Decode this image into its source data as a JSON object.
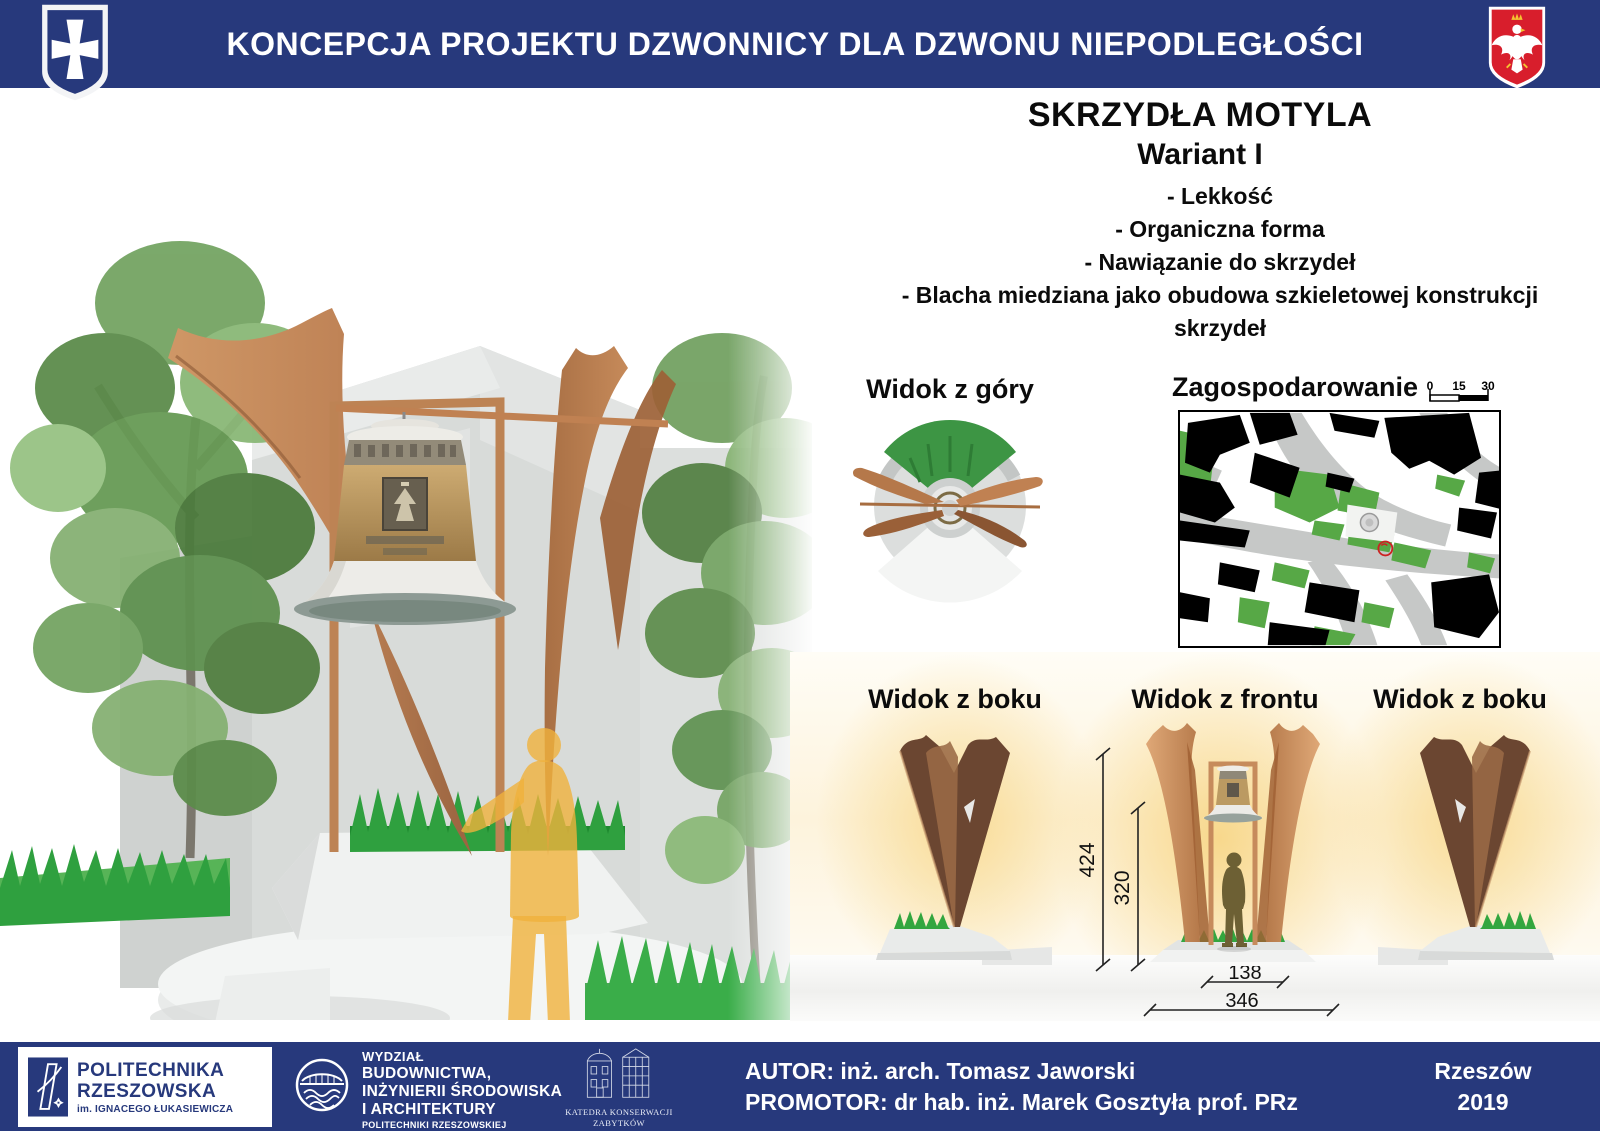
{
  "header": {
    "title": "KONCEPCJA PROJEKTU DZWONNICY DLA DZWONU NIEPODLEGŁOŚCI",
    "left_crest_icon": "rzeszow-coat-of-arms",
    "right_crest_icon": "polish-white-eagle"
  },
  "concept": {
    "title": "SKRZYDŁA MOTYLA",
    "variant": "Wariant I",
    "features": [
      "- Lekkość",
      "- Organiczna forma",
      "- Nawiązanie do skrzydeł",
      "- Blacha miedziana jako obudowa szkieletowej konstrukcji skrzydeł"
    ]
  },
  "views": {
    "top_view_label": "Widok z góry",
    "site_plan_label": "Zagospodarowanie",
    "scale_ticks": [
      "0",
      "15",
      "30"
    ],
    "side_left_label": "Widok z boku",
    "front_label": "Widok z frontu",
    "side_right_label": "Widok z boku"
  },
  "dimensions_cm": {
    "total_height": "424",
    "opening_height": "320",
    "opening_width": "138",
    "base_width": "346"
  },
  "footer": {
    "university_line1": "POLITECHNIKA",
    "university_line2": "RZESZOWSKA",
    "university_line3": "im. IGNACEGO ŁUKASIEWICZA",
    "faculty_line1": "WYDZIAŁ",
    "faculty_line2": "BUDOWNICTWA,",
    "faculty_line3": "INŻYNIERII ŚRODOWISKA",
    "faculty_line4": "I ARCHITEKTURY",
    "faculty_line5": "POLITECHNIKI RZESZOWSKIEJ",
    "department_line1": "KATEDRA KONSERWACJI",
    "department_line2": "ZABYTKÓW",
    "author": "AUTOR: inż. arch. Tomasz Jaworski",
    "promoter": "PROMOTOR:  dr hab. inż. Marek Gosztyła prof. PRz",
    "city": "Rzeszów",
    "year": "2019"
  },
  "colors": {
    "navy": "#27397c",
    "copper": "#b97c4c",
    "copper_dark": "#6e4a33",
    "grass_green": "#2fa03f",
    "map_green": "#57a846",
    "warm_glow": "#f8dc9e",
    "eagle_red": "#d81e2c"
  }
}
